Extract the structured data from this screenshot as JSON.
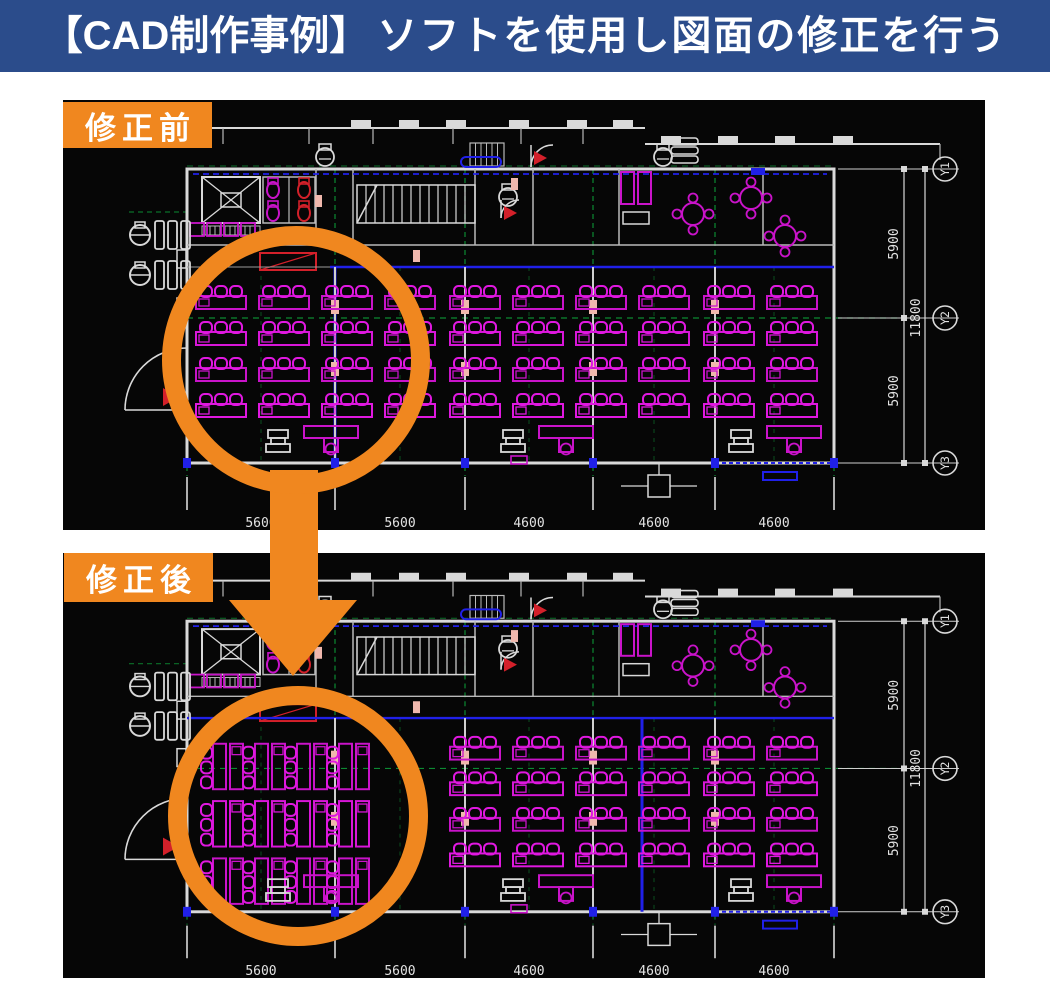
{
  "header": {
    "title_bracket": "【CAD制作事例】",
    "title_rest": "ソフトを使用し図面の修正を行う"
  },
  "figures": {
    "before": {
      "label": "修正前",
      "variant": "before"
    },
    "after": {
      "label": "修正後",
      "variant": "after"
    }
  },
  "cad": {
    "right_dims": {
      "segment_top": "5900",
      "total": "11800",
      "segment_bottom": "5900"
    },
    "grid_labels": [
      "Y1",
      "Y2",
      "Y3"
    ],
    "bottom_dims": [
      "5600",
      "5600",
      "4600",
      "4600",
      "4600"
    ]
  },
  "colors": {
    "banner_bg": "#2b4c8b",
    "accent_orange": "#f0871f",
    "cad_background": "#060606",
    "cad_wall": "#d9d9d9",
    "cad_magenta": "#c913c9",
    "cad_magenta_bright": "#e018e0",
    "cad_red": "#d3202a",
    "cad_blue": "#2020e8",
    "cad_green": "#0c8a32",
    "cad_pink": "#f0b8ad",
    "cad_text": "#e2e2e2"
  }
}
